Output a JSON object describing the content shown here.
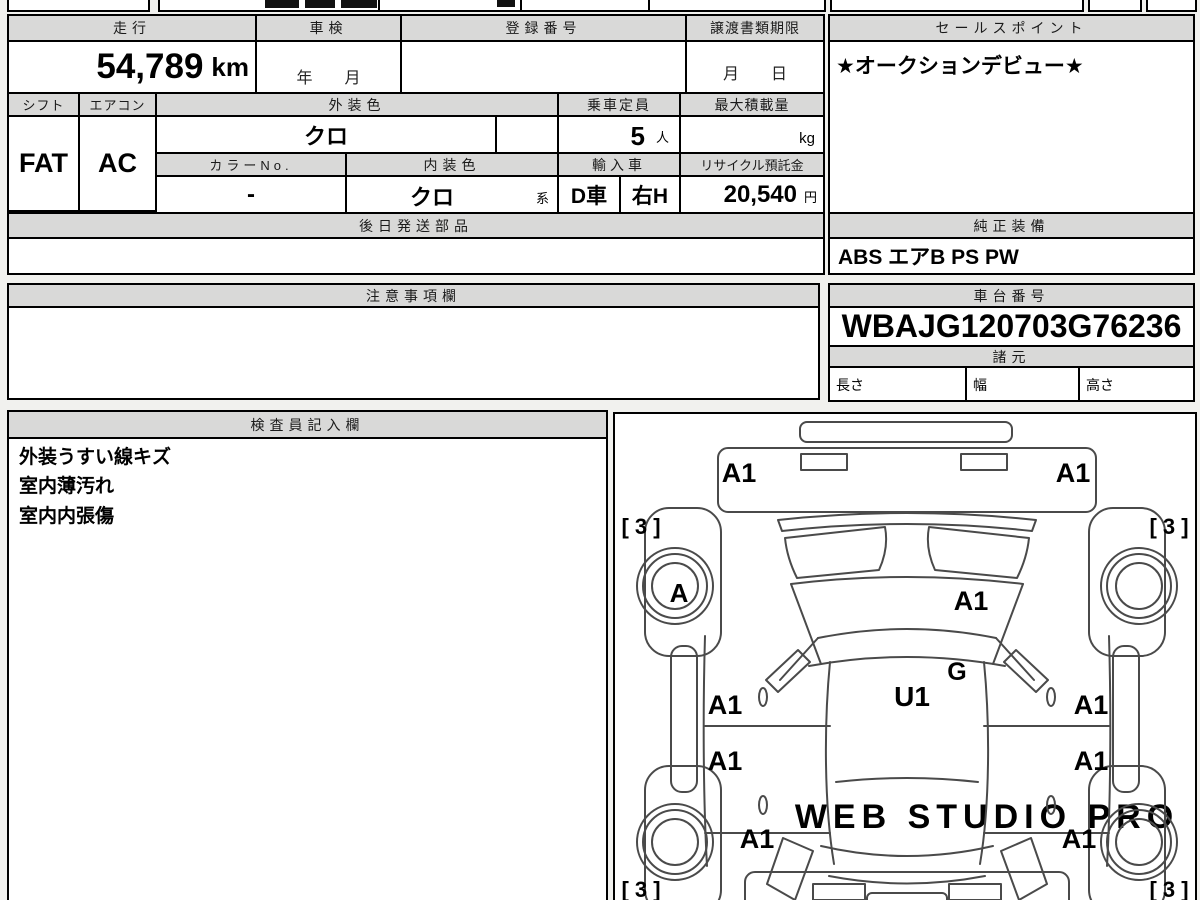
{
  "mileage": {
    "label": "走行",
    "value": "54,789",
    "unit": "km"
  },
  "shaken": {
    "label": "車検",
    "placeholder": "年　　月"
  },
  "registration": {
    "label": "登録番号",
    "value": ""
  },
  "transfer_deadline": {
    "label": "譲渡書類期限",
    "placeholder": "月　　日"
  },
  "sales_point": {
    "label": "セールスポイント",
    "value": "★オークションデビュー★"
  },
  "shift": {
    "label": "シフト",
    "value": "FAT"
  },
  "aircon": {
    "label": "エアコン",
    "value": "AC"
  },
  "exterior_color": {
    "label": "外装色",
    "value": "クロ"
  },
  "capacity": {
    "label": "乗車定員",
    "value": "5",
    "unit": "人"
  },
  "max_load": {
    "label": "最大積載量",
    "value": "",
    "unit": "kg"
  },
  "color_no": {
    "label": "カラーNo.",
    "value": "-"
  },
  "interior_color": {
    "label": "内装色",
    "value": "クロ",
    "suffix": "系"
  },
  "import_car": {
    "label": "輸入車",
    "value1": "D車",
    "value2": "右H"
  },
  "recycle_deposit": {
    "label": "リサイクル預託金",
    "value": "20,540",
    "unit": "円"
  },
  "later_parts": {
    "label": "後日発送部品",
    "value": ""
  },
  "equipment": {
    "label": "純正装備",
    "value": "ABS エアB PS PW"
  },
  "caution": {
    "label": "注意事項欄",
    "value": ""
  },
  "chassis": {
    "label": "車台番号",
    "value": "WBAJG120703G76236"
  },
  "specs": {
    "label": "諸元",
    "length_label": "長さ",
    "width_label": "幅",
    "height_label": "高さ",
    "length": "",
    "width": "",
    "height": ""
  },
  "inspector": {
    "label": "検査員記入欄",
    "lines": [
      "外装うすい線キズ",
      "室内薄汚れ",
      "室内内張傷"
    ]
  },
  "diagram": {
    "watermark": "WEB STUDIO PRO",
    "marks": {
      "front_bumper_left": "A1",
      "front_bumper_right": "A1",
      "hood": "A1",
      "cowl": "G",
      "roof": "U1",
      "door_front_left": "A1",
      "door_rear_left": "A1",
      "door_front_right": "A1",
      "door_rear_right": "A1",
      "quarter_left": "A1",
      "quarter_right": "A1",
      "wheel_front_left": "A",
      "tire_front_left": "[ 3 ]",
      "tire_front_right": "[ 3 ]",
      "tire_rear_left": "[ 3 ]",
      "tire_rear_right": "[ 3 ]"
    }
  },
  "colors": {
    "header_bg": "#d9d9d8",
    "border": "#000000",
    "page_bg": "#f1f1ee"
  }
}
